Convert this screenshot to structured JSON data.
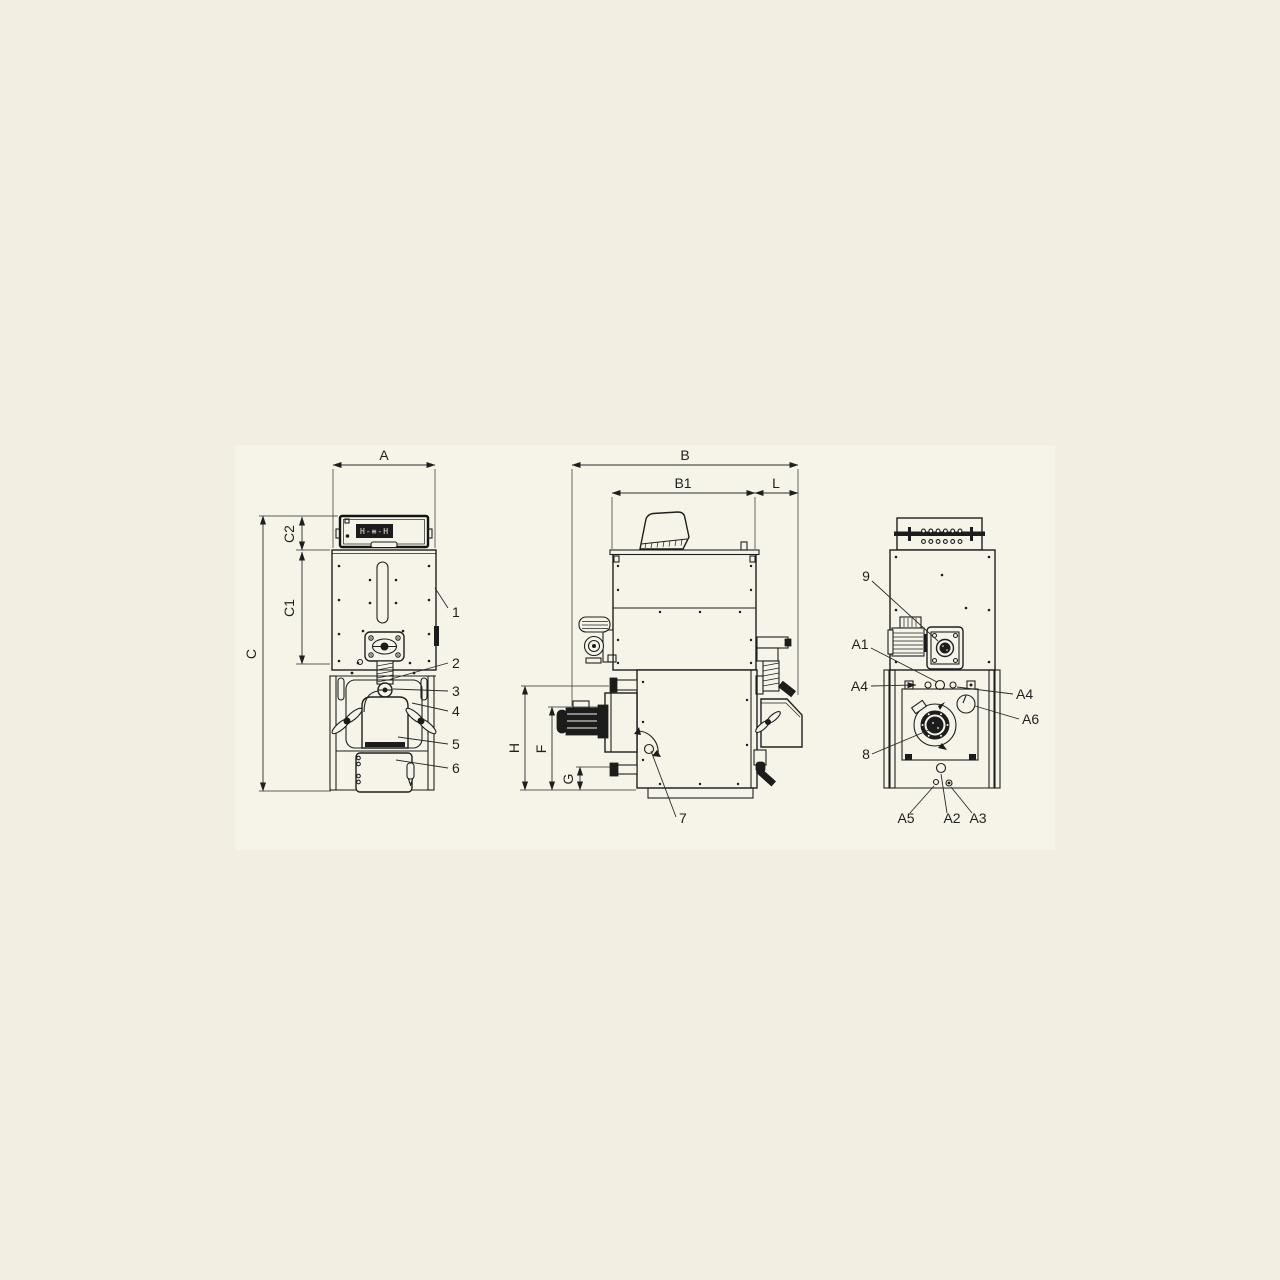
{
  "page": {
    "background": "#f2efe2",
    "paper_color": "#f6f4e9",
    "ink_color": "#1f1f1f"
  },
  "display": {
    "text": "H-≡-H"
  },
  "dimensions": {
    "a": "A",
    "b": "B",
    "b1": "B1",
    "l": "L",
    "c": "C",
    "c1": "C1",
    "c2": "C2",
    "h": "H",
    "f": "F",
    "g": "G"
  },
  "callouts": {
    "n1": "1",
    "n2": "2",
    "n3": "3",
    "n4": "4",
    "n5": "5",
    "n6": "6",
    "n7": "7",
    "n8": "8",
    "n9": "9",
    "a1": "A1",
    "a2": "A2",
    "a3": "A3",
    "a4_left": "A4",
    "a4_right": "A4",
    "a5": "A5",
    "a6": "A6"
  }
}
